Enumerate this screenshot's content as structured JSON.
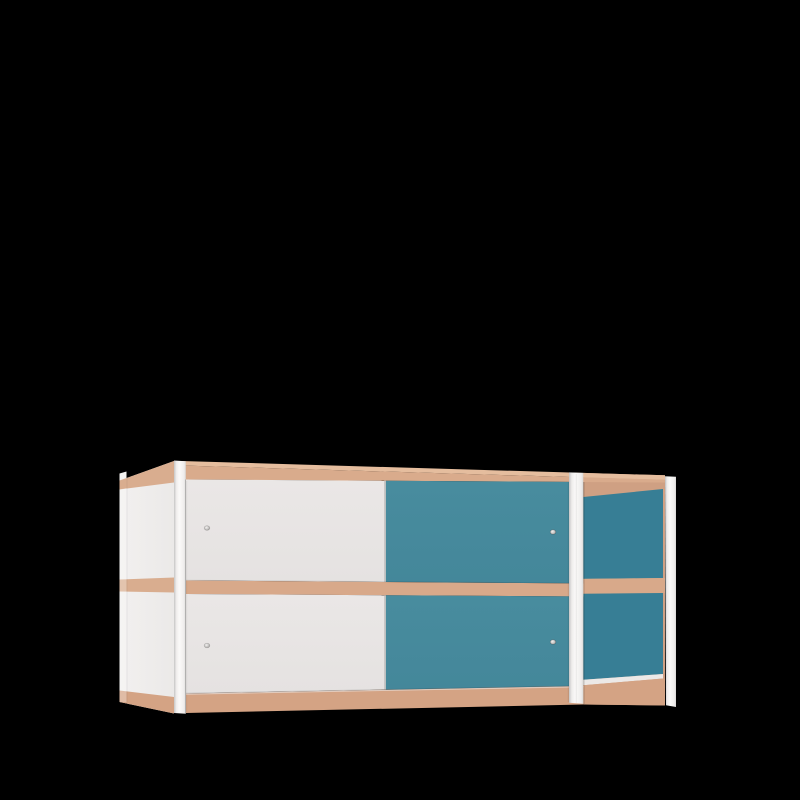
{
  "colors": {
    "background": "#000000",
    "wood_top_sliver": "#e5bd9e",
    "wood_front_edge": "#d9ab8c",
    "wood_mid_band": "#d8a98a",
    "wood_bottom_band": "#d4a384",
    "wood_side_band": "#d9ad8f",
    "wood_interior": "#cfa083",
    "door_white_top": "#eae7e6",
    "door_white_bottom": "#e5e2e1",
    "door_teal_top": "#488c9e",
    "door_teal_bottom": "#44879a",
    "teal_interior": "#377e95",
    "side_panel_back": "#f2f0ef",
    "side_panel_front": "#ebe9e8",
    "floor_white": "#ece9e7",
    "post_edge_dark": "#c6c5c5",
    "post_bright": "#fbfaf9",
    "post_mid": "#efedec",
    "post_edge_right": "#d9d8d7",
    "knob_center": "#f4f3f2",
    "knob_edge": "#9b9896",
    "door_gap_light": "#e4e2e1",
    "back_post_white": "#f3f2f1",
    "under_door_sliver": "#eeebe9"
  }
}
